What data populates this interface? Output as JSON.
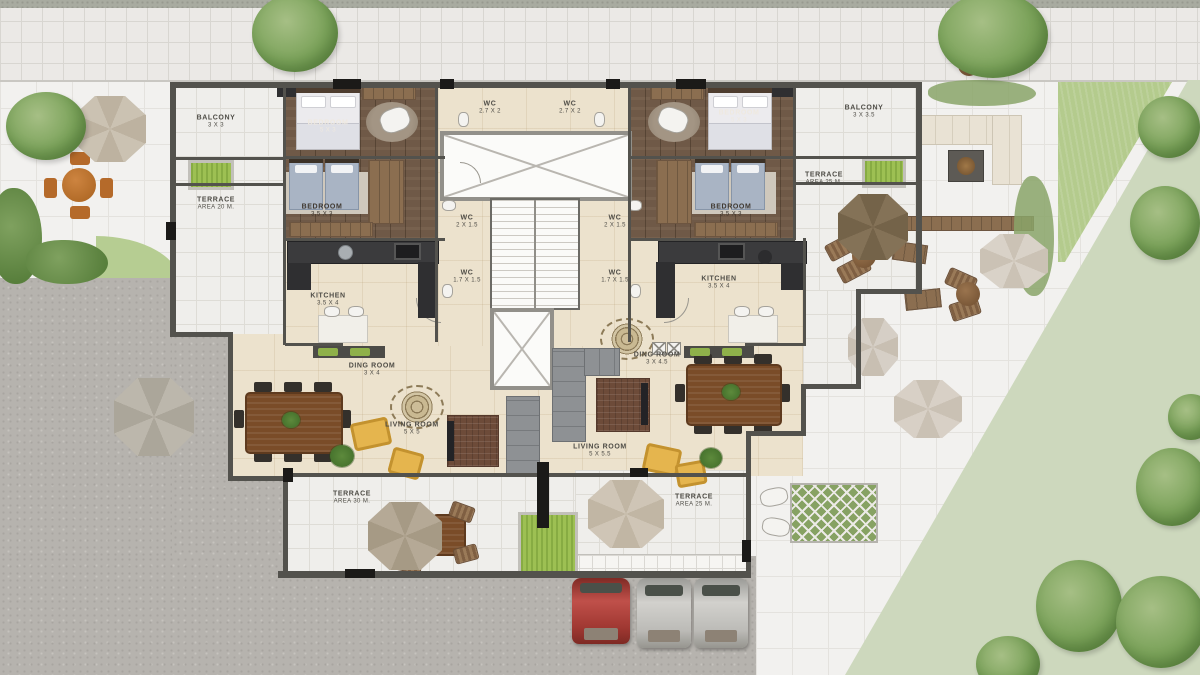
{
  "title": "Residential building floor plan with landscaped site",
  "rooms": {
    "balcony_left": {
      "label": "BALCONY",
      "size": "3 X 3"
    },
    "terrace_left": {
      "label": "TERRACE",
      "size": "AREA  20  M."
    },
    "bedroom_left_master": {
      "label": "BEDROOM",
      "size": "5 X 3"
    },
    "bedroom_left_kids": {
      "label": "BEDROOM",
      "size": "3.5 X 3"
    },
    "wc_top_left": {
      "label": "WC",
      "size": "2.7 X 2"
    },
    "wc_top_right": {
      "label": "WC",
      "size": "2.7 X 2"
    },
    "bedroom_right_master": {
      "label": "BEDROOM",
      "size": "5 X 3"
    },
    "balcony_right": {
      "label": "BALCONY",
      "size": "3 X 3.5"
    },
    "bedroom_right_kids": {
      "label": "BEDROOM",
      "size": "3.5 X 3"
    },
    "terrace_right": {
      "label": "TERRACE",
      "size": "AREA  25  M."
    },
    "wc_mid_left": {
      "label": "WC",
      "size": "2 X 1.5"
    },
    "wc_mid_right": {
      "label": "WC",
      "size": "2 X 1.5"
    },
    "wc_low_left": {
      "label": "WC",
      "size": "1.7 X 1.5"
    },
    "wc_low_right": {
      "label": "WC",
      "size": "1.7 X 1.5"
    },
    "kitchen_left": {
      "label": "KITCHEN",
      "size": "3.5 X 4"
    },
    "kitchen_right": {
      "label": "KITCHEN",
      "size": "3.5 X 4"
    },
    "dining_left": {
      "label": "DING ROOM",
      "size": "3 X 4"
    },
    "dining_right": {
      "label": "DING ROOM",
      "size": "3 X 4.5"
    },
    "living_left": {
      "label": "LIVING ROOM",
      "size": "5 X 5"
    },
    "living_right": {
      "label": "LIVING ROOM",
      "size": "5 X 5.5"
    },
    "terrace_bottom_left": {
      "label": "TERRACE",
      "size": "AREA  30  M."
    },
    "terrace_bottom_right": {
      "label": "TERRACE",
      "size": "AREA  25  M."
    }
  },
  "colors": {
    "wall": "#53524d",
    "accent_wall": "#1b1a18",
    "cream_floor": "#ece2cd",
    "wood_floor": "#6f5947",
    "tile_floor": "#efeeeb",
    "wc_floor": "#b6b1a8",
    "gravel": "#b6b3ae",
    "lawn_pale": "#cdd8bd",
    "lawn_bright": "#b4cb8d",
    "planter_green": "#9dc053",
    "tree_green": "#7ca35b",
    "sofa_gray": "#8e9194",
    "armchair_yellow": "#e5b54e",
    "dining_wood": "#7a4c28",
    "umbrella_beige": "#cbc2b2",
    "umbrella_brown": "#847257",
    "car_red": "#b0433a",
    "car_silver": "#c6c5c1"
  }
}
